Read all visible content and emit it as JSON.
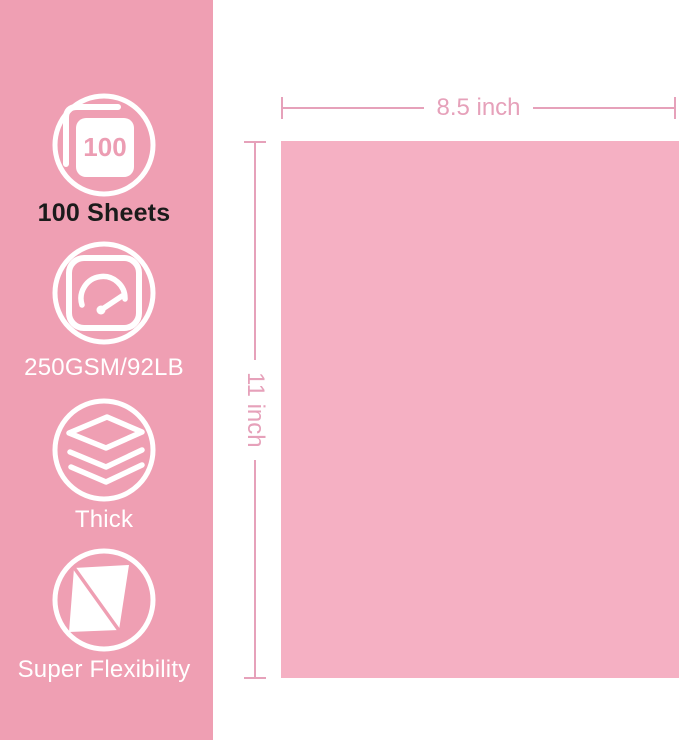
{
  "colors": {
    "sidebar_bg": "#ef9fb3",
    "paper_fill": "#f5b0c3",
    "dimension": "#e6a1ba",
    "icon_stroke": "#ffffff",
    "label_dark": "#1b1b1b",
    "label_light": "#ffffff",
    "icon_text_pink": "#ec9db3"
  },
  "features": [
    {
      "icon": "sheet-count-icon",
      "badge": "100",
      "label": "100 Sheets"
    },
    {
      "icon": "gsm-gauge-icon",
      "label": "250GSM/92LB"
    },
    {
      "icon": "thickness-layers-icon",
      "label": "Thick"
    },
    {
      "icon": "flexibility-sheet-icon",
      "label": "Super Flexibility"
    }
  ],
  "paper": {
    "width_label": "8.5 inch",
    "height_label": "11 inch"
  }
}
